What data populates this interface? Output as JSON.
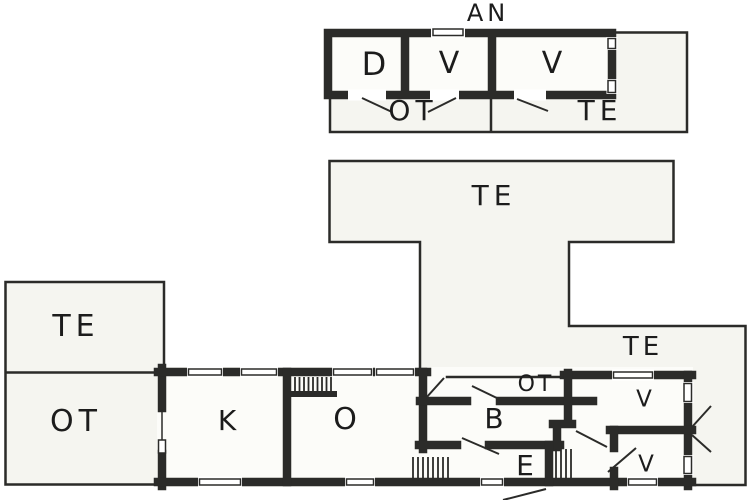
{
  "floor_plan": {
    "annex": {
      "title": "AN",
      "rooms": {
        "d": "D",
        "v1": "V",
        "v2": "V"
      },
      "areas": {
        "ot": "OT",
        "te": "TE"
      }
    },
    "terraces": {
      "main": "TE",
      "left": "TE",
      "left_open": "OT",
      "right": "TE"
    },
    "house": {
      "rooms": {
        "k": "K",
        "o": "O",
        "ot": "OT",
        "b": "B",
        "e": "E",
        "v1": "V",
        "v2": "V"
      }
    },
    "colors": {
      "wall": "#2b2b29",
      "room_fill": "#fcfcf9",
      "terrace_fill": "#f5f5f0",
      "label": "#1c1c1c",
      "background": "#ffffff"
    }
  }
}
